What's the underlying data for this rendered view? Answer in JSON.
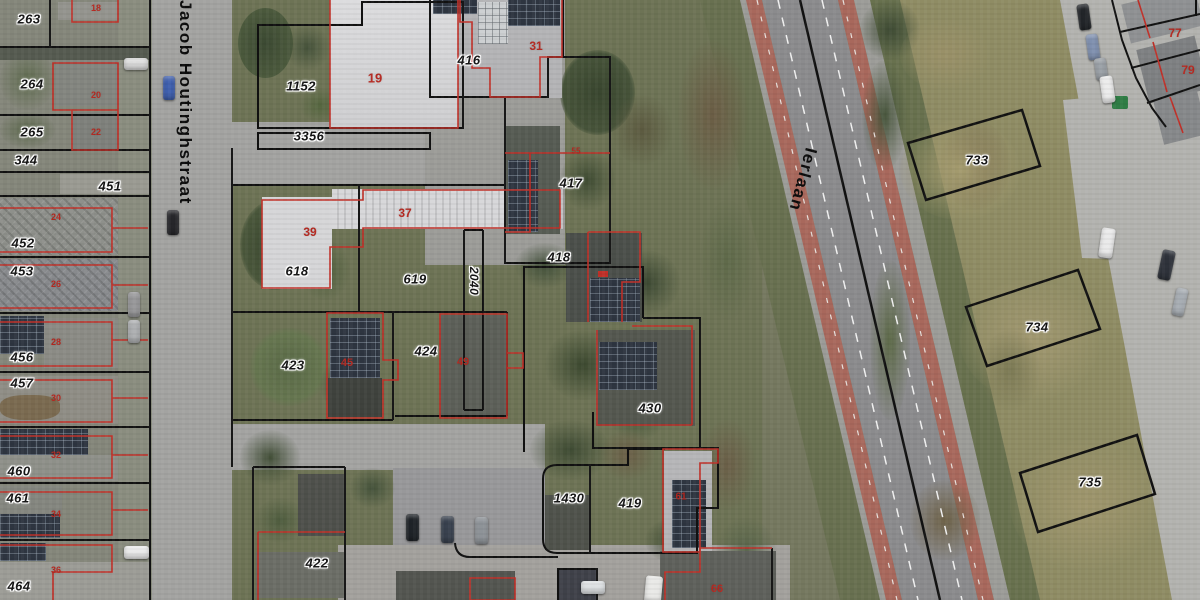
{
  "map": {
    "streets": [
      {
        "name": "Jacob Houtinghstraat"
      },
      {
        "name": "Ierlaan"
      }
    ],
    "parcel_labels": [
      {
        "t": "263",
        "x": 29,
        "y": 19
      },
      {
        "t": "264",
        "x": 32,
        "y": 84
      },
      {
        "t": "265",
        "x": 32,
        "y": 132
      },
      {
        "t": "344",
        "x": 26,
        "y": 160
      },
      {
        "t": "451",
        "x": 110,
        "y": 186
      },
      {
        "t": "452",
        "x": 23,
        "y": 243
      },
      {
        "t": "453",
        "x": 22,
        "y": 271
      },
      {
        "t": "456",
        "x": 22,
        "y": 357
      },
      {
        "t": "457",
        "x": 22,
        "y": 383
      },
      {
        "t": "460",
        "x": 19,
        "y": 471
      },
      {
        "t": "461",
        "x": 18,
        "y": 498
      },
      {
        "t": "464",
        "x": 19,
        "y": 586
      },
      {
        "t": "1152",
        "x": 301,
        "y": 86
      },
      {
        "t": "3356",
        "x": 309,
        "y": 136
      },
      {
        "t": "416",
        "x": 469,
        "y": 60
      },
      {
        "t": "417",
        "x": 571,
        "y": 183
      },
      {
        "t": "418",
        "x": 559,
        "y": 257
      },
      {
        "t": "618",
        "x": 297,
        "y": 271
      },
      {
        "t": "619",
        "x": 415,
        "y": 279
      },
      {
        "t": "2040",
        "x": 474,
        "y": 281,
        "r": 90,
        "fs": 12
      },
      {
        "t": "423",
        "x": 293,
        "y": 365
      },
      {
        "t": "424",
        "x": 426,
        "y": 351
      },
      {
        "t": "430",
        "x": 650,
        "y": 408
      },
      {
        "t": "1430",
        "x": 569,
        "y": 498
      },
      {
        "t": "419",
        "x": 630,
        "y": 503
      },
      {
        "t": "422",
        "x": 317,
        "y": 563
      },
      {
        "t": "733",
        "x": 977,
        "y": 160
      },
      {
        "t": "734",
        "x": 1037,
        "y": 327
      },
      {
        "t": "735",
        "x": 1090,
        "y": 482
      }
    ],
    "house_numbers": [
      {
        "t": "18",
        "x": 96,
        "y": 8,
        "fs": 9
      },
      {
        "t": "20",
        "x": 96,
        "y": 95,
        "fs": 9
      },
      {
        "t": "22",
        "x": 96,
        "y": 132,
        "fs": 9
      },
      {
        "t": "24",
        "x": 56,
        "y": 217,
        "fs": 9
      },
      {
        "t": "26",
        "x": 56,
        "y": 284,
        "fs": 9
      },
      {
        "t": "28",
        "x": 56,
        "y": 342,
        "fs": 9
      },
      {
        "t": "30",
        "x": 56,
        "y": 398,
        "fs": 9
      },
      {
        "t": "32",
        "x": 56,
        "y": 455,
        "fs": 9
      },
      {
        "t": "34",
        "x": 56,
        "y": 514,
        "fs": 9
      },
      {
        "t": "36",
        "x": 56,
        "y": 570,
        "fs": 9
      },
      {
        "t": "19",
        "x": 375,
        "y": 78,
        "fs": 13
      },
      {
        "t": "31",
        "x": 536,
        "y": 46,
        "fs": 12
      },
      {
        "t": "37",
        "x": 405,
        "y": 213,
        "fs": 12
      },
      {
        "t": "39",
        "x": 310,
        "y": 232,
        "fs": 12
      },
      {
        "t": "45",
        "x": 347,
        "y": 363,
        "fs": 11
      },
      {
        "t": "49",
        "x": 463,
        "y": 362,
        "fs": 11
      },
      {
        "t": "55",
        "x": 576,
        "y": 151,
        "fs": 8
      },
      {
        "t": "61",
        "x": 681,
        "y": 497,
        "fs": 10
      },
      {
        "t": "66",
        "x": 717,
        "y": 589,
        "fs": 11
      },
      {
        "t": "77",
        "x": 1175,
        "y": 33,
        "fs": 12
      },
      {
        "t": "79",
        "x": 1188,
        "y": 70,
        "fs": 12
      }
    ],
    "colors": {
      "parcel_outline": "#111111",
      "building_outline": "#c03028",
      "house_number": "#b5271f",
      "label_halo": "#ffffff",
      "cycle_lane": "#a8685c",
      "asphalt": "#8b8b8d"
    }
  },
  "geometry": {
    "paths": [
      {
        "n": "street-edge-left",
        "d": "M150,0 V600",
        "s": "#111111",
        "w": 2
      },
      {
        "n": "parcel-row-line",
        "d": "M0,47 H150",
        "s": "#111111",
        "w": 2
      },
      {
        "n": "parcel-row-line",
        "d": "M0,115 H150",
        "s": "#111111",
        "w": 2
      },
      {
        "n": "parcel-row-line",
        "d": "M0,150 H150",
        "s": "#111111",
        "w": 2
      },
      {
        "n": "parcel-row-line",
        "d": "M0,172 H150",
        "s": "#111111",
        "w": 2
      },
      {
        "n": "parcel-row-line",
        "d": "M0,196 H150",
        "s": "#111111",
        "w": 2
      },
      {
        "n": "parcel-row-line",
        "d": "M0,257 H150",
        "s": "#111111",
        "w": 2
      },
      {
        "n": "parcel-row-line",
        "d": "M0,313 H150",
        "s": "#111111",
        "w": 2
      },
      {
        "n": "parcel-row-line",
        "d": "M0,372 H150",
        "s": "#111111",
        "w": 2
      },
      {
        "n": "parcel-row-line",
        "d": "M0,427 H150",
        "s": "#111111",
        "w": 2
      },
      {
        "n": "parcel-row-line",
        "d": "M0,483 H150",
        "s": "#111111",
        "w": 2
      },
      {
        "n": "parcel-row-line",
        "d": "M0,540 H150",
        "s": "#111111",
        "w": 2
      },
      {
        "n": "parcel-divider",
        "d": "M50,0 V47",
        "s": "#111111",
        "w": 2
      },
      {
        "n": "parcel-1152",
        "d": "M258,128 L258,25 L362,25 L362,2 L463,2 L463,128 Z",
        "s": "#111111",
        "w": 2
      },
      {
        "n": "parcel-3356",
        "d": "M258,133 H430 V149 H258 Z",
        "s": "#111111",
        "w": 2
      },
      {
        "n": "parcel-416",
        "d": "M430,0 L430,97 L548,97 L548,57 L563,57 L563,0",
        "s": "#111111",
        "w": 2
      },
      {
        "n": "parcel-417",
        "d": "M548,97 L505,97 L505,263 L610,263 L610,57 L563,57",
        "s": "#111111",
        "w": 2
      },
      {
        "n": "parcel-418",
        "d": "M643,318 L643,267 L524,267 L524,452",
        "s": "#111111",
        "w": 2
      },
      {
        "n": "parcel-430",
        "d": "M643,318 L700,318 L700,448 L593,448 L593,412",
        "s": "#111111",
        "w": 2
      },
      {
        "n": "parcel-419-1430",
        "d": "M664,448 L718,448 L718,508 L697,508 L697,553 L557,553 Q543,553 543,539 L543,479 Q543,465 557,465 L628,465 L628,449 L664,449 Z",
        "s": "#111111",
        "w": 2
      },
      {
        "n": "parcel-divider",
        "d": "M590,465 V553",
        "s": "#111111",
        "w": 2
      },
      {
        "n": "parcel-row-line",
        "d": "M232,185 H505",
        "s": "#111111",
        "w": 2
      },
      {
        "n": "parcel-divider",
        "d": "M359,185 V312",
        "s": "#111111",
        "w": 2
      },
      {
        "n": "parcel-row-line",
        "d": "M232,312 H507",
        "s": "#111111",
        "w": 2
      },
      {
        "n": "parcel-divider",
        "d": "M393,312 V420",
        "s": "#111111",
        "w": 2
      },
      {
        "n": "parcel-row-line",
        "d": "M232,420 H393",
        "s": "#111111",
        "w": 2
      },
      {
        "n": "parcel-divider",
        "d": "M507,312 V416",
        "s": "#111111",
        "w": 2
      },
      {
        "n": "parcel-row-line",
        "d": "M395,416 H507",
        "s": "#111111",
        "w": 2
      },
      {
        "n": "parcel-2040",
        "d": "M464,230 V410 M483,230 V410 M464,230 H483 M464,410 H483",
        "s": "#111111",
        "w": 2
      },
      {
        "n": "street-edge-right",
        "d": "M232,148 V467",
        "s": "#111111",
        "w": 2
      },
      {
        "n": "parcel-422",
        "d": "M253,467 V600 M253,467 H345 M345,467 V600",
        "s": "#111111",
        "w": 2
      },
      {
        "n": "building-outline-black",
        "d": "M558,600 V569 H597 V600",
        "s": "#111111",
        "w": 2
      },
      {
        "n": "parcel-curve",
        "d": "M455,543 Q456,557 470,557 L558,557",
        "s": "#111111",
        "w": 2
      },
      {
        "n": "parcel-boundary",
        "d": "M772,548 V600",
        "s": "#111111",
        "w": 2
      },
      {
        "n": "parcel-733",
        "d": "M908,143 L1022,110 L1040,166 L926,200 Z",
        "s": "#111111",
        "w": 2.5
      },
      {
        "n": "parcel-734",
        "d": "M966,307 L1078,270 L1100,329 L987,366 Z",
        "s": "#111111",
        "w": 2.5
      },
      {
        "n": "parcel-735",
        "d": "M1020,473 L1137,435 L1155,494 L1038,532 Z",
        "s": "#111111",
        "w": 2.5
      },
      {
        "n": "road-center-line",
        "d": "M800,0 L940,600",
        "s": "#111111",
        "w": 2.5
      },
      {
        "n": "parcel-front-curve",
        "d": "M1112,0 L1122,40 L1136,78 L1152,108 L1166,127",
        "s": "#111111",
        "w": 2
      },
      {
        "n": "parcel-row-line",
        "d": "M1120,32 L1200,14",
        "s": "#111111",
        "w": 2
      },
      {
        "n": "parcel-row-line",
        "d": "M1131,68 L1200,50",
        "s": "#111111",
        "w": 2
      },
      {
        "n": "parcel-row-line",
        "d": "M1147,103 L1200,85",
        "s": "#111111",
        "w": 2
      },
      {
        "n": "parcel-corner",
        "d": "M1196,0 V16",
        "s": "#111111",
        "w": 2
      },
      {
        "n": "lane-dash",
        "d": "M778,0 L918,600",
        "s": "#f2f2f2",
        "w": 1.5,
        "da": "9 9"
      },
      {
        "n": "lane-dash",
        "d": "M822,0 L962,600",
        "s": "#f2f2f2",
        "w": 1.5,
        "da": "9 9"
      },
      {
        "n": "cycle-dash",
        "d": "M757,0 L897,600",
        "s": "#e8e2de",
        "w": 1.2,
        "da": "5 12"
      },
      {
        "n": "cycle-dash",
        "d": "M843,0 L983,600",
        "s": "#e8e2de",
        "w": 1.2,
        "da": "5 12"
      },
      {
        "n": "building-18",
        "d": "M72,0 V22 H118 V0",
        "s": "#c03028",
        "w": 1.6
      },
      {
        "n": "building-20-22",
        "d": "M53,63 L118,63 L118,150 L72,150 L72,110 L53,110 Z",
        "s": "#c03028",
        "w": 1.6
      },
      {
        "n": "building-divider",
        "d": "M72,110 H118",
        "s": "#c03028",
        "w": 1.6
      },
      {
        "n": "building-row",
        "d": "M0,208 H112 V252 H0",
        "s": "#c03028",
        "w": 1.6
      },
      {
        "n": "building-stub",
        "d": "M112,228 H148",
        "s": "#c03028",
        "w": 1.6
      },
      {
        "n": "building-row",
        "d": "M0,265 H112 V308 H0",
        "s": "#c03028",
        "w": 1.6
      },
      {
        "n": "building-stub",
        "d": "M112,285 H148",
        "s": "#c03028",
        "w": 1.6
      },
      {
        "n": "building-row",
        "d": "M0,322 H112 V366 H0",
        "s": "#c03028",
        "w": 1.6
      },
      {
        "n": "building-stub",
        "d": "M112,340 H148",
        "s": "#c03028",
        "w": 1.6
      },
      {
        "n": "building-row",
        "d": "M0,380 H112 V422 H0",
        "s": "#c03028",
        "w": 1.6
      },
      {
        "n": "building-stub",
        "d": "M112,398 H148",
        "s": "#c03028",
        "w": 1.6
      },
      {
        "n": "building-row",
        "d": "M0,436 H112 V478 H0",
        "s": "#c03028",
        "w": 1.6
      },
      {
        "n": "building-stub",
        "d": "M112,455 H148",
        "s": "#c03028",
        "w": 1.6
      },
      {
        "n": "building-row",
        "d": "M0,492 H112 V535 H0",
        "s": "#c03028",
        "w": 1.6
      },
      {
        "n": "building-stub",
        "d": "M112,510 H148",
        "s": "#c03028",
        "w": 1.6
      },
      {
        "n": "building-row",
        "d": "M0,545 H112 V572 H53 V600",
        "s": "#c03028",
        "w": 1.6
      },
      {
        "n": "building-19",
        "d": "M330,0 L330,128 L458,128 L458,0",
        "s": "#c03028",
        "w": 1.6
      },
      {
        "n": "building-31",
        "d": "M460,0 L460,22 L472,22 L472,68 L490,68 L490,97 L540,97 L540,57 L562,57 L562,0",
        "s": "#c03028",
        "w": 1.6
      },
      {
        "n": "building-37-39",
        "d": "M262,200 L262,288 L330,288 L330,247 L363,247 L363,228 L560,228 L560,190 L363,190 L363,200 Z",
        "s": "#c03028",
        "w": 1.6
      },
      {
        "n": "building-45",
        "d": "M327,313 H383 V360 H398 V380 H383 V418 H327 Z",
        "s": "#c03028",
        "w": 1.6
      },
      {
        "n": "building-49",
        "d": "M440,314 H507 V418 H440 Z",
        "s": "#c03028",
        "w": 1.6
      },
      {
        "n": "building-49-step",
        "d": "M507,353 H523 V368 H507",
        "s": "#c03028",
        "w": 1.6
      },
      {
        "n": "building-line-417",
        "d": "M505,153 H610",
        "s": "#c03028",
        "w": 1.6
      },
      {
        "n": "building-417",
        "d": "M530,153 V232 H505",
        "s": "#c03028",
        "w": 1.6
      },
      {
        "n": "building-418",
        "d": "M588,232 V322",
        "s": "#c03028",
        "w": 1.6
      },
      {
        "n": "building-418b",
        "d": "M588,232 H640 V282 H622 V322",
        "s": "#c03028",
        "w": 1.6
      },
      {
        "n": "building-430",
        "d": "M632,326 H692 V425",
        "s": "#c03028",
        "w": 1.6
      },
      {
        "n": "building-430b",
        "d": "M597,330 V425 H692",
        "s": "#c03028",
        "w": 1.6
      },
      {
        "n": "building-61",
        "d": "M663,552 L663,449 L718,449 L718,463 L700,463 L700,552 Z",
        "s": "#c03028",
        "w": 1.6
      },
      {
        "n": "building-bottom",
        "d": "M470,578 H515 V600 H470 Z",
        "s": "#c03028",
        "w": 1.6
      },
      {
        "n": "building-66",
        "d": "M665,600 V572 H700 V548 H772",
        "s": "#c03028",
        "w": 1.6
      },
      {
        "n": "building-422",
        "d": "M258,532 H345 M258,532 V600",
        "s": "#c03028",
        "w": 1.6
      },
      {
        "n": "building-topright",
        "d": "M1138,0 L1150,38 M1153,42 L1167,92 M1170,97 L1183,133",
        "s": "#c03028",
        "w": 1.6
      },
      {
        "n": "roof-marker",
        "d": "M598,271 h10 v6 h-10 Z",
        "s": "none",
        "w": 0,
        "f": "#c03028"
      }
    ]
  }
}
